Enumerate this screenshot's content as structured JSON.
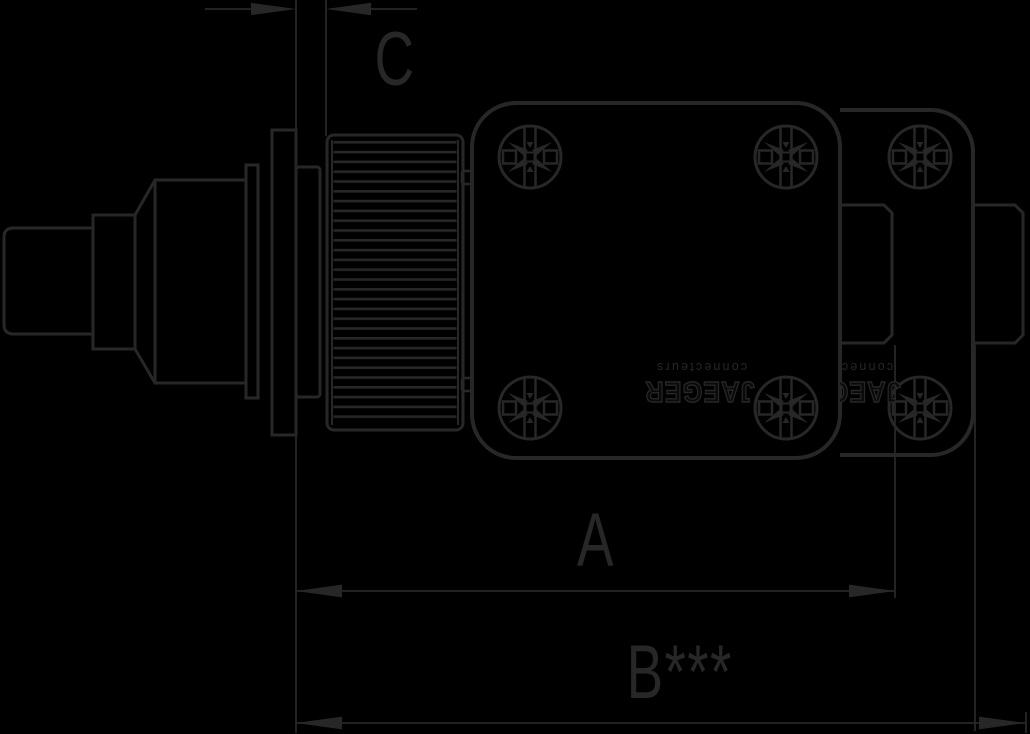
{
  "colors": {
    "background": "#000000",
    "line": "#272727"
  },
  "drawing": {
    "brand": {
      "name": "JAEGER",
      "tagline": "connecteurs"
    },
    "dimension_labels": {
      "a": "A",
      "b": "B***",
      "c": "C"
    }
  }
}
